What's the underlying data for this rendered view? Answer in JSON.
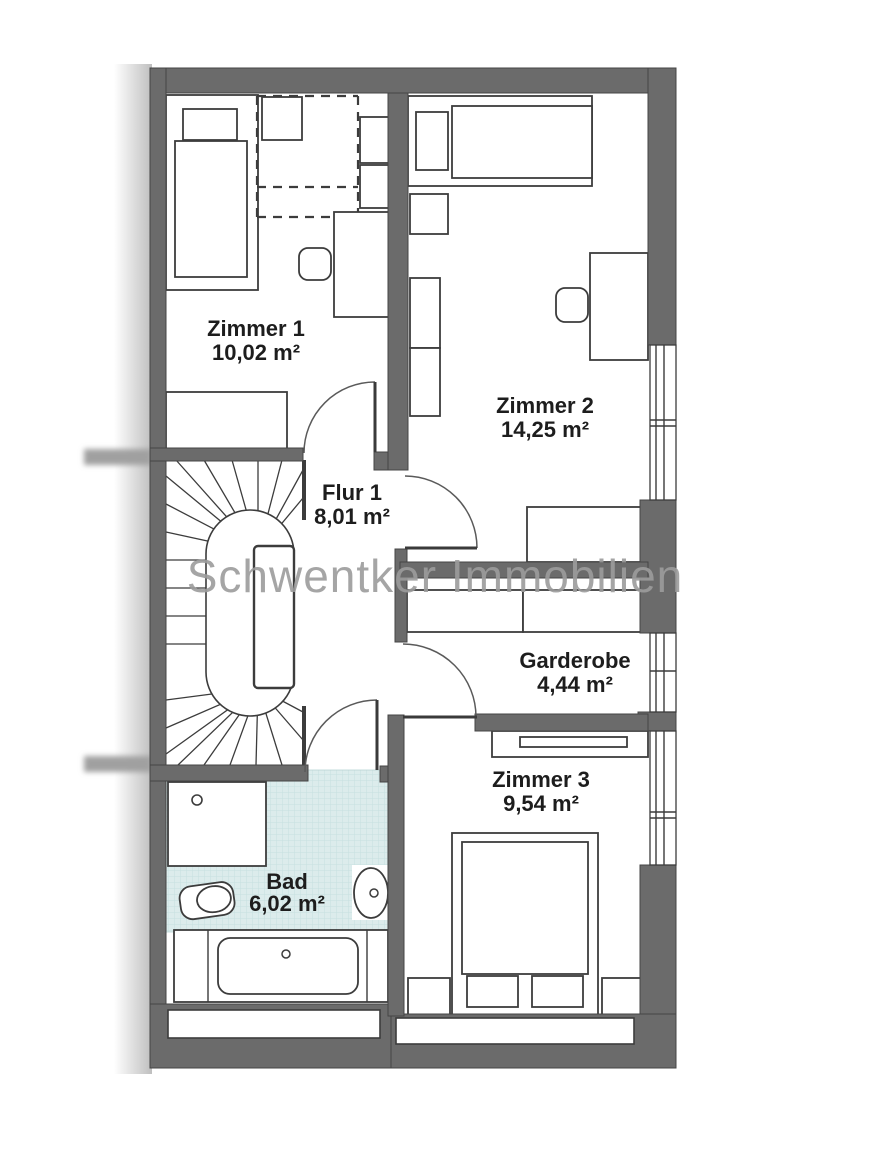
{
  "watermark": "Schwentker Immobilien",
  "rooms": [
    {
      "id": "zimmer1",
      "name": "Zimmer 1",
      "area": "10,02 m²"
    },
    {
      "id": "zimmer2",
      "name": "Zimmer 2",
      "area": "14,25 m²"
    },
    {
      "id": "flur1",
      "name": "Flur 1",
      "area": "8,01 m²"
    },
    {
      "id": "garderobe",
      "name": "Garderobe",
      "area": "4,44 m²"
    },
    {
      "id": "zimmer3",
      "name": "Zimmer 3",
      "area": "9,54 m²"
    },
    {
      "id": "bad",
      "name": "Bad",
      "area": "6,02 m²"
    }
  ],
  "colors": {
    "wall": "#6b6b6b",
    "line": "#3c3c3c",
    "tile": "#dcecec",
    "tile_grid": "#c6e0e0",
    "watermark": "#9c9c9c",
    "label": "#1d1d1d",
    "background": "#ffffff"
  }
}
